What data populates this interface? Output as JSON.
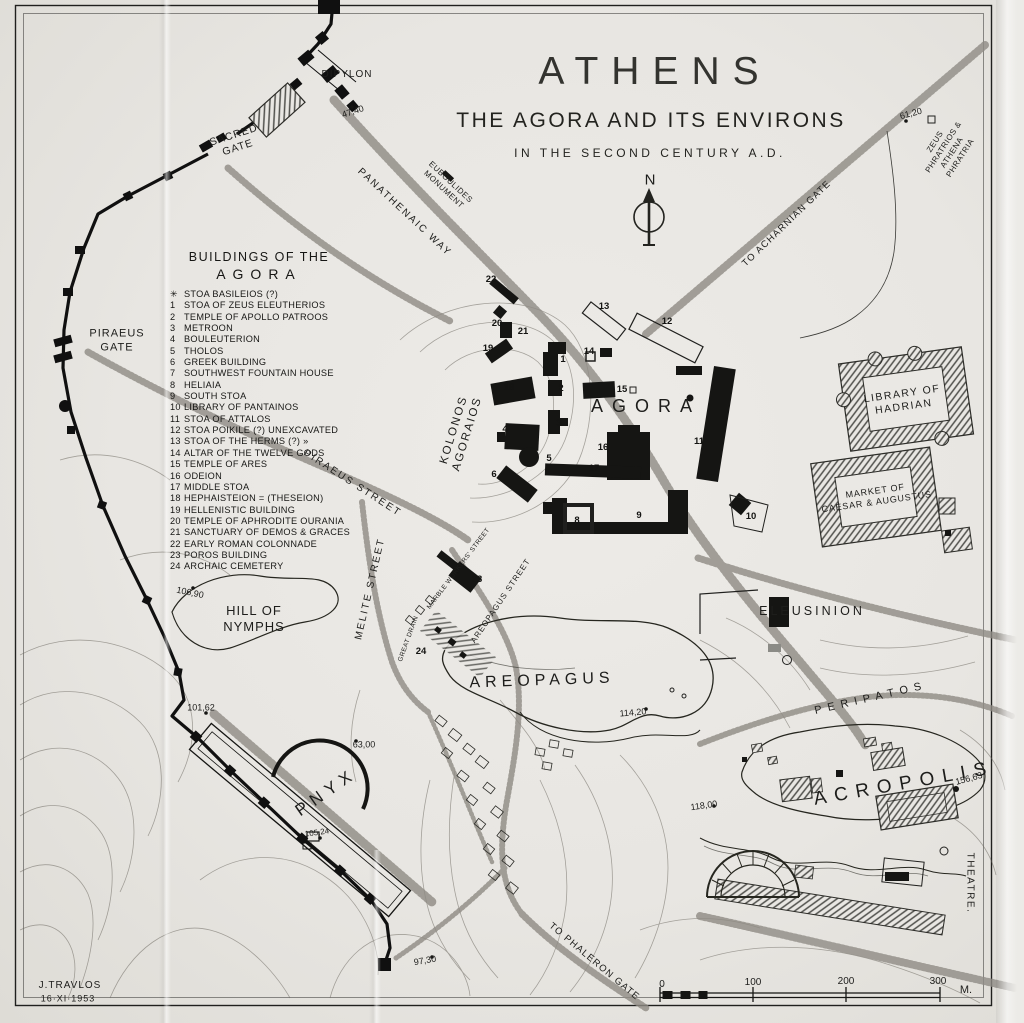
{
  "colors": {
    "ink": "#1d1d1b",
    "paper": "#eae8e4",
    "hatch": "#4a4a48",
    "road_stipple": "#8f8b84"
  },
  "title": {
    "main": "ATHENS",
    "subtitle": "THE AGORA AND ITS ENVIRONS",
    "era": "IN THE SECOND CENTURY A.D."
  },
  "legend": {
    "title_line1": "BUILDINGS OF THE",
    "title_line2": "AGORA",
    "items": [
      {
        "num": "✳",
        "label": "STOA BASILEIOS (?)"
      },
      {
        "num": "1",
        "label": "STOA OF ZEUS ELEUTHERIOS"
      },
      {
        "num": "2",
        "label": "TEMPLE OF APOLLO PATROOS"
      },
      {
        "num": "3",
        "label": "METROON"
      },
      {
        "num": "4",
        "label": "BOULEUTERION"
      },
      {
        "num": "5",
        "label": "THOLOS"
      },
      {
        "num": "6",
        "label": "GREEK BUILDING"
      },
      {
        "num": "7",
        "label": "SOUTHWEST FOUNTAIN HOUSE"
      },
      {
        "num": "8",
        "label": "HELIAIA"
      },
      {
        "num": "9",
        "label": "SOUTH STOA"
      },
      {
        "num": "10",
        "label": "LIBRARY OF PANTAINOS"
      },
      {
        "num": "11",
        "label": "STOA OF ATTALOS"
      },
      {
        "num": "12",
        "label": "STOA POIKILE (?) UNEXCAVATED"
      },
      {
        "num": "13",
        "label": "STOA OF THE HERMS (?)  »"
      },
      {
        "num": "14",
        "label": "ALTAR OF THE TWELVE GODS"
      },
      {
        "num": "15",
        "label": "TEMPLE OF ARES"
      },
      {
        "num": "16",
        "label": "ODEION"
      },
      {
        "num": "17",
        "label": "MIDDLE STOA"
      },
      {
        "num": "18",
        "label": "HEPHAISTEION = (THESEION)"
      },
      {
        "num": "19",
        "label": "HELLENISTIC BUILDING"
      },
      {
        "num": "20",
        "label": "TEMPLE OF APHRODITE OURANIA"
      },
      {
        "num": "21",
        "label": "SANCTUARY OF DEMOS & GRACES"
      },
      {
        "num": "22",
        "label": "EARLY ROMAN COLONNADE"
      },
      {
        "num": "23",
        "label": "POROS BUILDING"
      },
      {
        "num": "24",
        "label": "ARCHAIC CEMETERY"
      }
    ]
  },
  "map": {
    "labels": [
      {
        "name": "compass-n-label",
        "text": "N",
        "x": 650,
        "y": 181,
        "fs": 15,
        "ls": 0
      },
      {
        "name": "label-dipylon",
        "text": "DIPYLON",
        "x": 347,
        "y": 75,
        "fs": 10,
        "ls": 1
      },
      {
        "name": "elevation-47-40",
        "text": "47,40",
        "x": 353,
        "y": 112,
        "fs": 9,
        "rot": -18
      },
      {
        "name": "label-sacred-gate",
        "text": "SACRED\nGATE",
        "x": 236,
        "y": 142,
        "fs": 10.5,
        "rot": -18,
        "ls": 1
      },
      {
        "name": "label-euboulides-monument",
        "text": "EUBOULIDES\nMONUMENT",
        "x": 447,
        "y": 186,
        "fs": 8,
        "rot": 43,
        "ls": 0.5
      },
      {
        "name": "label-panathenaic-way",
        "text": "PANATHENAIC WAY",
        "x": 404,
        "y": 213,
        "fs": 10,
        "rot": 43,
        "ls": 2
      },
      {
        "name": "label-to-acharnian-gate",
        "text": "TO ACHARNIAN GATE",
        "x": 787,
        "y": 224,
        "fs": 9.5,
        "rot": -44,
        "ls": 1.2
      },
      {
        "name": "elevation-61-20",
        "text": "61,20",
        "x": 911,
        "y": 114,
        "fs": 9,
        "rot": -15
      },
      {
        "name": "label-zeus-phratrios",
        "text": "ZEUS PHRATRIOS &\nATHENA PHRATRIA",
        "x": 948,
        "y": 150,
        "fs": 8,
        "rot": -57,
        "ls": 0.5
      },
      {
        "name": "label-piraeus-gate",
        "text": "PIRAEUS\nGATE",
        "x": 117,
        "y": 341,
        "fs": 11,
        "ls": 1
      },
      {
        "name": "label-kolonos-agoraios",
        "text": "KOLONOS\nAGORAIOS",
        "x": 461,
        "y": 432,
        "fs": 11.5,
        "rot": -73,
        "ls": 2
      },
      {
        "name": "label-agora",
        "text": "AGORA",
        "x": 646,
        "y": 406,
        "fs": 18,
        "ls": 9
      },
      {
        "name": "label-piraeus-street",
        "text": "PIRAEUS STREET",
        "x": 352,
        "y": 484,
        "fs": 10,
        "rot": 33,
        "ls": 2
      },
      {
        "name": "label-melite-street",
        "text": "MELITE STREET",
        "x": 371,
        "y": 589,
        "fs": 10,
        "rot": -77,
        "ls": 2
      },
      {
        "name": "label-marble-workers-street",
        "text": "MARBLE WORKERS' STREET",
        "x": 459,
        "y": 569,
        "fs": 6.5,
        "rot": -53,
        "ls": 0.4
      },
      {
        "name": "label-areopagus-street",
        "text": "AREOPAGUS STREET",
        "x": 501,
        "y": 601,
        "fs": 8,
        "rot": -56,
        "ls": 1
      },
      {
        "name": "label-great-drain",
        "text": "GREAT DRAIN",
        "x": 409,
        "y": 639,
        "fs": 6.5,
        "rot": -70,
        "ls": 0.4
      },
      {
        "name": "label-hill-of-nymphs",
        "text": "HILL OF\nNYMPHS",
        "x": 254,
        "y": 619,
        "fs": 13,
        "ls": 1
      },
      {
        "name": "elevation-106-90",
        "text": "106,90",
        "x": 190,
        "y": 593,
        "fs": 9,
        "rot": 12
      },
      {
        "name": "elevation-101-62",
        "text": "101,62",
        "x": 201,
        "y": 708,
        "fs": 9
      },
      {
        "name": "label-pnyx",
        "text": "PNYX",
        "x": 326,
        "y": 792,
        "fs": 17,
        "rot": -35,
        "ls": 6
      },
      {
        "name": "elevation-63-00",
        "text": "63,00",
        "x": 364,
        "y": 745,
        "fs": 9
      },
      {
        "name": "elevation-105-24",
        "text": "105,24",
        "x": 317,
        "y": 833,
        "fs": 8,
        "rot": -8
      },
      {
        "name": "label-areopagus",
        "text": "AREOPAGUS",
        "x": 542,
        "y": 681,
        "fs": 16,
        "rot": -2,
        "ls": 5
      },
      {
        "name": "elevation-114-20",
        "text": "114,20",
        "x": 633,
        "y": 713,
        "fs": 9,
        "rot": -5
      },
      {
        "name": "label-eleusinion",
        "text": "ELEUSINION",
        "x": 812,
        "y": 612,
        "fs": 12.5,
        "ls": 3
      },
      {
        "name": "label-peripatos",
        "text": "PERIPATOS",
        "x": 871,
        "y": 699,
        "fs": 11,
        "rot": -13,
        "ls": 6
      },
      {
        "name": "label-acropolis",
        "text": "ACROPOLIS",
        "x": 904,
        "y": 784,
        "fs": 19,
        "rot": -10,
        "ls": 8
      },
      {
        "name": "elevation-156-63",
        "text": "156,63",
        "x": 969,
        "y": 779,
        "fs": 9,
        "rot": -15
      },
      {
        "name": "elevation-118-00",
        "text": "118,00",
        "x": 704,
        "y": 806,
        "fs": 9,
        "rot": -8
      },
      {
        "name": "label-theatre",
        "text": "THEATRE.",
        "x": 969,
        "y": 883,
        "fs": 10,
        "rot": 90,
        "ls": 1.5
      },
      {
        "name": "label-to-phaleron-gate",
        "text": "TO PHALERON GATE",
        "x": 594,
        "y": 962,
        "fs": 9.5,
        "rot": 40,
        "ls": 1.2
      },
      {
        "name": "elevation-97-30",
        "text": "97,30",
        "x": 425,
        "y": 961,
        "fs": 9,
        "rot": -10
      },
      {
        "name": "signature-name",
        "text": "J.TRAVLOS",
        "x": 70,
        "y": 986,
        "fs": 10,
        "ls": 1
      },
      {
        "name": "signature-date",
        "text": "16·XI·1953",
        "x": 68,
        "y": 999,
        "fs": 9,
        "ls": 1
      },
      {
        "name": "scale-tick-0",
        "text": "0",
        "x": 662,
        "y": 985,
        "fs": 10
      },
      {
        "name": "scale-tick-100",
        "text": "100",
        "x": 753,
        "y": 983,
        "fs": 10
      },
      {
        "name": "scale-tick-200",
        "text": "200",
        "x": 846,
        "y": 982,
        "fs": 10
      },
      {
        "name": "scale-tick-300",
        "text": "300",
        "x": 938,
        "y": 982,
        "fs": 10
      },
      {
        "name": "scale-unit",
        "text": "M.",
        "x": 966,
        "y": 991,
        "fs": 11
      },
      {
        "name": "label-library-of-hadrian",
        "text": "LIBRARY OF\nHADRIAN",
        "x": 903,
        "y": 401,
        "fs": 10.5,
        "rot": -8,
        "ls": 1.5
      },
      {
        "name": "label-market-of-caesar",
        "text": "MARKET OF\nCAESAR & AUGUSTUS",
        "x": 876,
        "y": 497,
        "fs": 9,
        "rot": -8,
        "ls": 0.8
      }
    ],
    "building_markers": [
      {
        "n": "1",
        "x": 563,
        "y": 360
      },
      {
        "n": "2",
        "x": 561,
        "y": 389
      },
      {
        "n": "3",
        "x": 559,
        "y": 424
      },
      {
        "n": "4",
        "x": 505,
        "y": 430
      },
      {
        "n": "5",
        "x": 549,
        "y": 459
      },
      {
        "n": "6",
        "x": 494,
        "y": 475
      },
      {
        "n": "7",
        "x": 549,
        "y": 511
      },
      {
        "n": "8",
        "x": 577,
        "y": 521
      },
      {
        "n": "9",
        "x": 639,
        "y": 516
      },
      {
        "n": "10",
        "x": 751,
        "y": 517
      },
      {
        "n": "11",
        "x": 699,
        "y": 442
      },
      {
        "n": "12",
        "x": 667,
        "y": 322
      },
      {
        "n": "13",
        "x": 604,
        "y": 307
      },
      {
        "n": "14",
        "x": 589,
        "y": 352
      },
      {
        "n": "15",
        "x": 622,
        "y": 390
      },
      {
        "n": "16",
        "x": 603,
        "y": 448
      },
      {
        "n": "17",
        "x": 594,
        "y": 469
      },
      {
        "n": "18",
        "x": 509,
        "y": 388
      },
      {
        "n": "19",
        "x": 488,
        "y": 349
      },
      {
        "n": "20",
        "x": 497,
        "y": 324
      },
      {
        "n": "21",
        "x": 523,
        "y": 332
      },
      {
        "n": "22",
        "x": 491,
        "y": 280
      },
      {
        "n": "23",
        "x": 477,
        "y": 580
      },
      {
        "n": "24",
        "x": 421,
        "y": 652
      }
    ]
  }
}
